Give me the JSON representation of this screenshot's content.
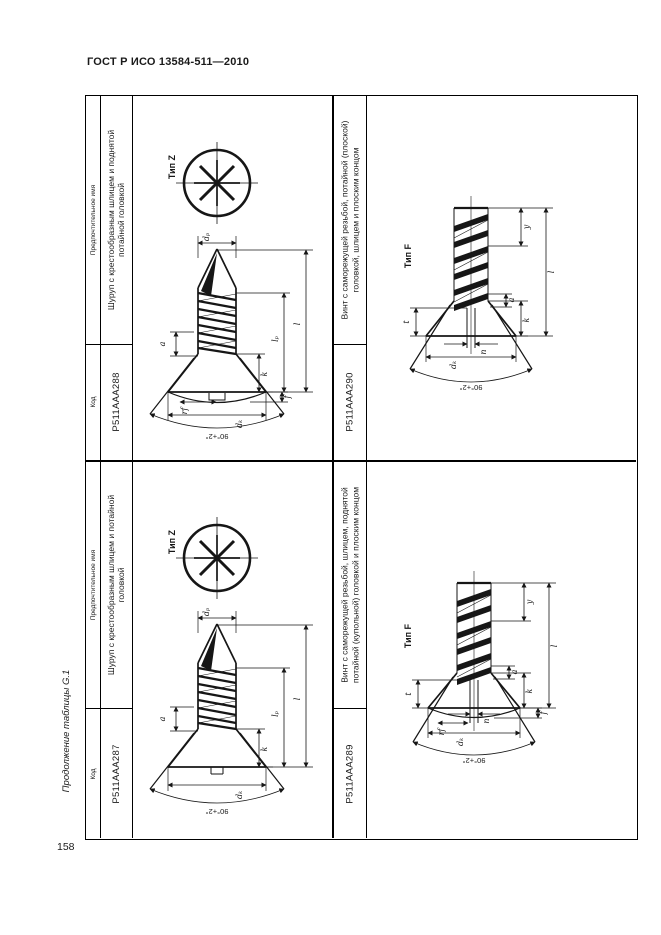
{
  "page": {
    "doc_title": "ГОСТ Р ИСО 13584-511—2010",
    "side_caption": "Продолжение таблицы G.1",
    "page_number": "158"
  },
  "table": {
    "headers": {
      "code": "Код",
      "name": "Предпочтительное имя"
    },
    "entries": [
      {
        "code": "P511AAA288",
        "name": "Шуруп с крестообразным шлицем и поднятой потайной головкой",
        "type_label": "Тип Z",
        "angle": "90°+2°",
        "dims": {
          "dp": "dₚ",
          "l": "l",
          "lp": "lₚ",
          "a": "a",
          "k": "k",
          "f": "f",
          "rf": "rf",
          "dk": "dₖ"
        }
      },
      {
        "code": "P511AAA290",
        "name": "Винт с саморежущей резьбой, потайной (плоской) головкой, шлицем и плоским концом",
        "type_label": "Тип F",
        "angle": "90°+2°",
        "dims": {
          "y": "y",
          "l": "l",
          "a": "a",
          "k": "k",
          "t": "t",
          "n": "n",
          "dk": "dₖ"
        }
      },
      {
        "code": "P511AAA287",
        "name": "Шуруп с крестообразным шлицем и потайной головкой",
        "type_label": "Тип Z",
        "angle": "90°+2°",
        "dims": {
          "dp": "dₚ",
          "l": "l",
          "lp": "lₚ",
          "a": "a",
          "k": "k",
          "dk": "dₖ"
        }
      },
      {
        "code": "P511AAA289",
        "name": "Винт с саморежущей резьбой, шлицем, поднятой потайной (купольной) головкой и плоским концом",
        "type_label": "Тип F",
        "angle": "90°+2°",
        "dims": {
          "y": "y",
          "l": "l",
          "a": "a",
          "k": "k",
          "f": "f",
          "t": "t",
          "rf": "rf",
          "n": "n",
          "dk": "dₖ"
        }
      }
    ]
  }
}
